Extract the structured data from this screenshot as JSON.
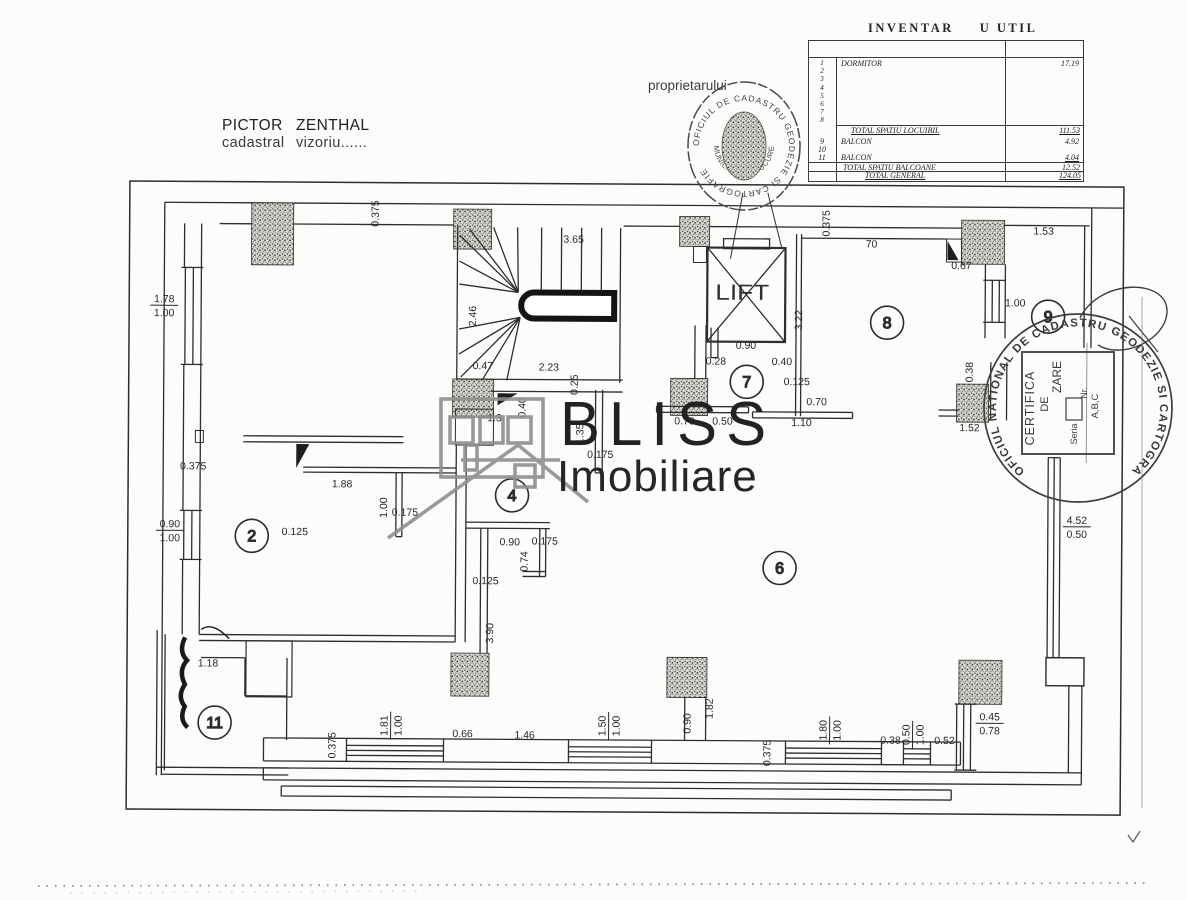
{
  "title_block": {
    "line1_left": "PICTOR",
    "line1_right": "ZENTHAL",
    "line2_left": "cadastral",
    "line2_right": "vizoriu......"
  },
  "annotations": {
    "owner_label": "proprietarului"
  },
  "inventory": {
    "title_left": "INVENTAR",
    "title_right": "U UTIL",
    "item_numbers": [
      "1",
      "2",
      "3",
      "4",
      "5",
      "6",
      "7",
      "8"
    ],
    "first_item": {
      "label": "DORMITOR",
      "value": "17.19"
    },
    "subtotal": {
      "label": "TOTAL SPATIU LOCUIBIL",
      "value": "111.53"
    },
    "balcony_rows": [
      {
        "num": "9",
        "label": "BALCON",
        "value": "4.92"
      },
      {
        "num": "10",
        "label": "",
        "value": ""
      },
      {
        "num": "11",
        "label": "BALCON",
        "value": "4.04"
      }
    ],
    "balcony_total": {
      "label": "TOTAL SPATIU BALCOANE",
      "value": "12.52"
    },
    "grand_total": {
      "label": "TOTAL GENERAL",
      "value": "124.05"
    }
  },
  "logo": {
    "name": "BLISS",
    "sub": "Imobiliare"
  },
  "stamps": {
    "round_small": {
      "ring_text": "OFICIUL DE CADASTRU  GEODEZIE SI CARTOGRAFIE",
      "inner_text": "MUNICIPIULUI BUCURESTI"
    },
    "round_large": {
      "ring_text": "OFICIUL NATIONAL DE CADASTRU  GEODEZIE SI CARTOGRAFIE   ROMANIA",
      "box_line1": "CERTIFICA",
      "box_line2": "DE",
      "box_line3": "ZARE",
      "box_line4": "Seria",
      "box_line5": "Nr.",
      "box_line6": "A,B,C"
    }
  },
  "plan": {
    "lift_label": "LIFT",
    "rooms": [
      {
        "n": "2",
        "x": 252,
        "y": 538
      },
      {
        "n": "4",
        "x": 512,
        "y": 496
      },
      {
        "n": "6",
        "x": 780,
        "y": 567
      },
      {
        "n": "7",
        "x": 746,
        "y": 381
      },
      {
        "n": "8",
        "x": 886,
        "y": 321
      },
      {
        "n": "9",
        "x": 1047,
        "y": 314
      },
      {
        "n": "11",
        "x": 216,
        "y": 725
      }
    ],
    "dimensions": [
      {
        "t": "0.375",
        "x": 377,
        "y": 215,
        "r": -90
      },
      {
        "t": "3.65",
        "x": 572,
        "y": 243,
        "r": 0
      },
      {
        "t": "2.46",
        "x": 475,
        "y": 317,
        "r": -90
      },
      {
        "t": "0.47",
        "x": 482,
        "y": 370,
        "r": 0
      },
      {
        "t": "2.23",
        "x": 548,
        "y": 371,
        "r": 0
      },
      {
        "t": "0.25",
        "x": 577,
        "y": 385,
        "r": -90
      },
      {
        "t": "0.40",
        "x": 525,
        "y": 408,
        "r": -90
      },
      {
        "t": "1.35",
        "x": 583,
        "y": 434,
        "r": -90
      },
      {
        "t": "0.175",
        "x": 600,
        "y": 458,
        "r": 0
      },
      {
        "t": "1.3",
        "x": 494,
        "y": 422,
        "r": 0
      },
      {
        "t": "0.70",
        "x": 684,
        "y": 424,
        "r": 0
      },
      {
        "t": "0.50",
        "x": 722,
        "y": 424,
        "r": 0
      },
      {
        "t": "0.90",
        "x": 745,
        "y": 348,
        "r": 0
      },
      {
        "t": "0.28",
        "x": 715,
        "y": 364,
        "r": 0
      },
      {
        "t": "0.40",
        "x": 781,
        "y": 364,
        "r": 0
      },
      {
        "t": "0.125",
        "x": 796,
        "y": 384,
        "r": 0
      },
      {
        "t": "0.70",
        "x": 816,
        "y": 404,
        "r": 0
      },
      {
        "t": "1.10",
        "x": 801,
        "y": 425,
        "r": 0
      },
      {
        "t": "3.22",
        "x": 801,
        "y": 319,
        "r": -90
      },
      {
        "t": "0.375",
        "x": 828,
        "y": 222,
        "r": -90
      },
      {
        "t": "70",
        "x": 870,
        "y": 246,
        "r": 0
      },
      {
        "t": "0.67",
        "x": 960,
        "y": 267,
        "r": 0
      },
      {
        "t": "1.53",
        "x": 1042,
        "y": 232,
        "r": 0
      },
      {
        "t": "1.00",
        "x": 1014,
        "y": 304,
        "r": 0
      },
      {
        "t": "0.375",
        "x": 193,
        "y": 472,
        "r": 0
      },
      {
        "t": "1.88",
        "x": 342,
        "y": 489,
        "r": 0
      },
      {
        "t": "1.00",
        "x": 387,
        "y": 509,
        "r": -90
      },
      {
        "t": "0.175",
        "x": 405,
        "y": 517,
        "r": 0
      },
      {
        "t": "0.125",
        "x": 295,
        "y": 537,
        "r": 0
      },
      {
        "t": "0.90",
        "x": 510,
        "y": 546,
        "r": 0
      },
      {
        "t": "0.175",
        "x": 545,
        "y": 545,
        "r": 0
      },
      {
        "t": "0.74",
        "x": 528,
        "y": 562,
        "r": -90
      },
      {
        "t": "0.125",
        "x": 486,
        "y": 585,
        "r": 0
      },
      {
        "t": "3.90",
        "x": 494,
        "y": 634,
        "r": -90
      },
      {
        "t": "1.18",
        "x": 209,
        "y": 669,
        "r": 0
      },
      {
        "t": "0.375",
        "x": 337,
        "y": 747,
        "r": -90
      },
      {
        "t": "0.66",
        "x": 464,
        "y": 738,
        "r": 0
      },
      {
        "t": "1.46",
        "x": 526,
        "y": 739,
        "r": 0
      },
      {
        "t": "0.90",
        "x": 692,
        "y": 723,
        "r": -90
      },
      {
        "t": "1.82",
        "x": 714,
        "y": 708,
        "r": -90
      },
      {
        "t": "0.375",
        "x": 772,
        "y": 752,
        "r": -90
      },
      {
        "t": "0.38",
        "x": 892,
        "y": 742,
        "r": 0
      },
      {
        "t": "0.52",
        "x": 946,
        "y": 742,
        "r": 0
      },
      {
        "t": "1.52",
        "x": 969,
        "y": 429,
        "r": 0
      },
      {
        "t": "0.38",
        "x": 972,
        "y": 370,
        "r": -90
      }
    ],
    "fractions": [
      {
        "top": "1.78",
        "bot": "1.00",
        "x": 163,
        "y": 308,
        "r": 0
      },
      {
        "top": "0.90",
        "bot": "1.00",
        "x": 170,
        "y": 533,
        "r": 0
      },
      {
        "top": "1.81",
        "bot": "1.00",
        "x": 392,
        "y": 727,
        "r": -90
      },
      {
        "top": "1.50",
        "bot": "1.00",
        "x": 610,
        "y": 726,
        "r": -90
      },
      {
        "top": "1.80",
        "bot": "1.00",
        "x": 831,
        "y": 729,
        "r": -90
      },
      {
        "top": "0.50",
        "bot": "1.00",
        "x": 914,
        "y": 733,
        "r": -90
      },
      {
        "top": "0.45",
        "bot": "0.78",
        "x": 991,
        "y": 721,
        "r": 0
      },
      {
        "top": "4.52",
        "bot": "0.50",
        "x": 1077,
        "y": 524,
        "r": 0
      }
    ]
  }
}
